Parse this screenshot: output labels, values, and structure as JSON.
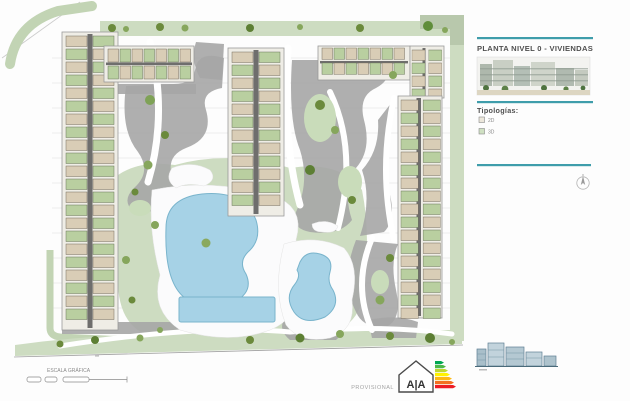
{
  "panel": {
    "title": "PLANTA NIVEL 0 - VIVIENDAS",
    "tipologias_label": "Tipologías:",
    "legend": [
      {
        "label": "2D",
        "swatch_color": "#ece7db"
      },
      {
        "label": "3D",
        "swatch_color": "#cfe0c2"
      }
    ]
  },
  "footer": {
    "scale_label": "ESCALA GRÁFICA",
    "provisional_label": "PROVISIONAL",
    "logo_text": "A|A"
  },
  "palette": {
    "accent_teal": "#3f9dab",
    "lawn_green": "#cddcc1",
    "band_green": "#c2d4b4",
    "gravel_gray": "#a6a6a6",
    "pool_blue": "#a6d2e6",
    "pool_outline": "#79b4cc",
    "unit_beige": "#d9cdb6",
    "unit_green": "#b9cfa0",
    "energy_scale_colors": [
      "#00a651",
      "#4cb848",
      "#bfd730",
      "#fff200",
      "#fdb913",
      "#f37021",
      "#ed1c24"
    ]
  },
  "icons": {
    "compass": "north-arrow-icon",
    "energy_label": "energy-rating-icon",
    "logo": "aa-house-logo-icon",
    "trees": "tree-icon"
  }
}
